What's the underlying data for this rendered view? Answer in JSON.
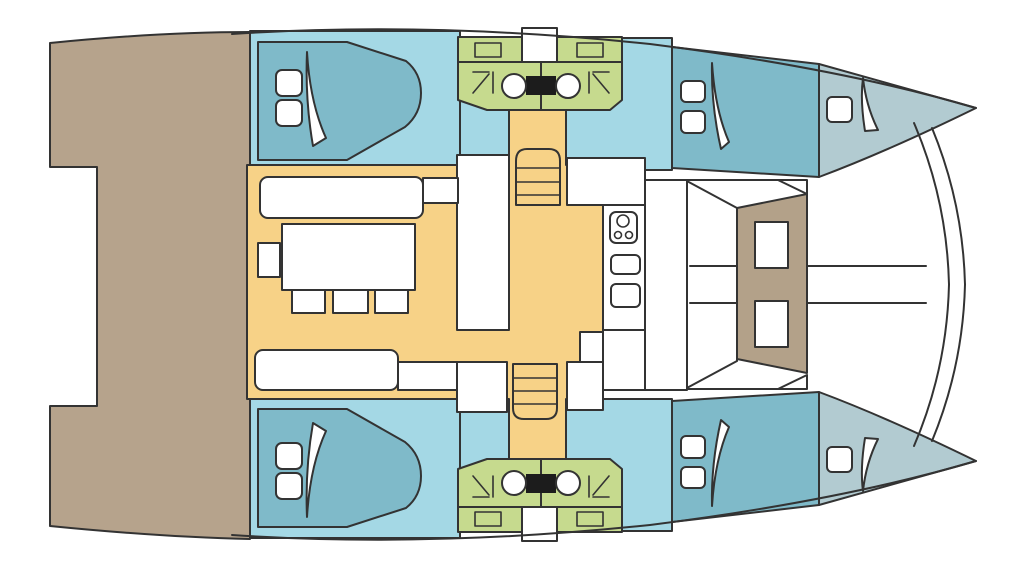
{
  "diagram": {
    "type": "floor-plan",
    "subject": "catamaran-yacht-deck-plan",
    "view": "top-down",
    "orientation": "bow-right"
  },
  "colors": {
    "background": "#ffffff",
    "outline": "#333333",
    "deck": "#b6a38c",
    "saloon_floor": "#f7d287",
    "hull_interior": "#a4d8e5",
    "berth": "#7fbac9",
    "bow_locker": "#b2cbd1",
    "head_compartment": "#c6da8e",
    "cockpit_table": "#b3a189",
    "fixture_dark": "#1c1c1c",
    "furniture": "#ffffff"
  },
  "features": {
    "double_berth_cabins": 4,
    "head_compartments": 2,
    "toilets": 2,
    "shower_symbols": 2,
    "bathroom_sinks": 4,
    "stairways": 2,
    "saloon_tables": 1,
    "saloon_chairs": 3,
    "galley_burners": 3,
    "galley_sinks": 2,
    "cockpit_tables": 1,
    "bow_hatches": 2,
    "berth_pillows": 8
  }
}
